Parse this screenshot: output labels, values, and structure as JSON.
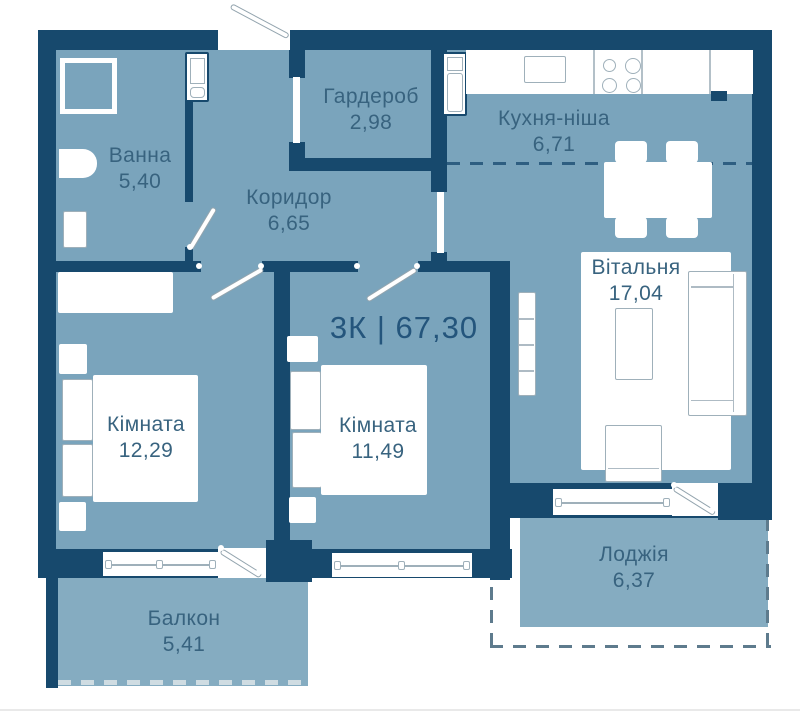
{
  "plan": {
    "title": "3К | 67,30",
    "rooms": [
      {
        "id": "bathroom",
        "name": "Ванна",
        "area": "5,40"
      },
      {
        "id": "wardrobe",
        "name": "Гардероб",
        "area": "2,98"
      },
      {
        "id": "kitchen",
        "name": "Кухня-ніша",
        "area": "6,71"
      },
      {
        "id": "corridor",
        "name": "Коридор",
        "area": "6,65"
      },
      {
        "id": "living",
        "name": "Вітальня",
        "area": "17,04"
      },
      {
        "id": "bedroom1",
        "name": "Кімната",
        "area": "12,29"
      },
      {
        "id": "bedroom2",
        "name": "Кімната",
        "area": "11,49"
      },
      {
        "id": "loggia",
        "name": "Лоджія",
        "area": "6,37"
      },
      {
        "id": "balcony",
        "name": "Балкон",
        "area": "5,41"
      }
    ],
    "colors": {
      "wall": "#17496d",
      "floor": "#7AA4BC",
      "outdoor_floor": "#85ACC1",
      "label_text": "#38637F",
      "title_text": "#24557C",
      "furniture_outline": "#9FB0BA",
      "background": "#FFFFFF"
    }
  }
}
